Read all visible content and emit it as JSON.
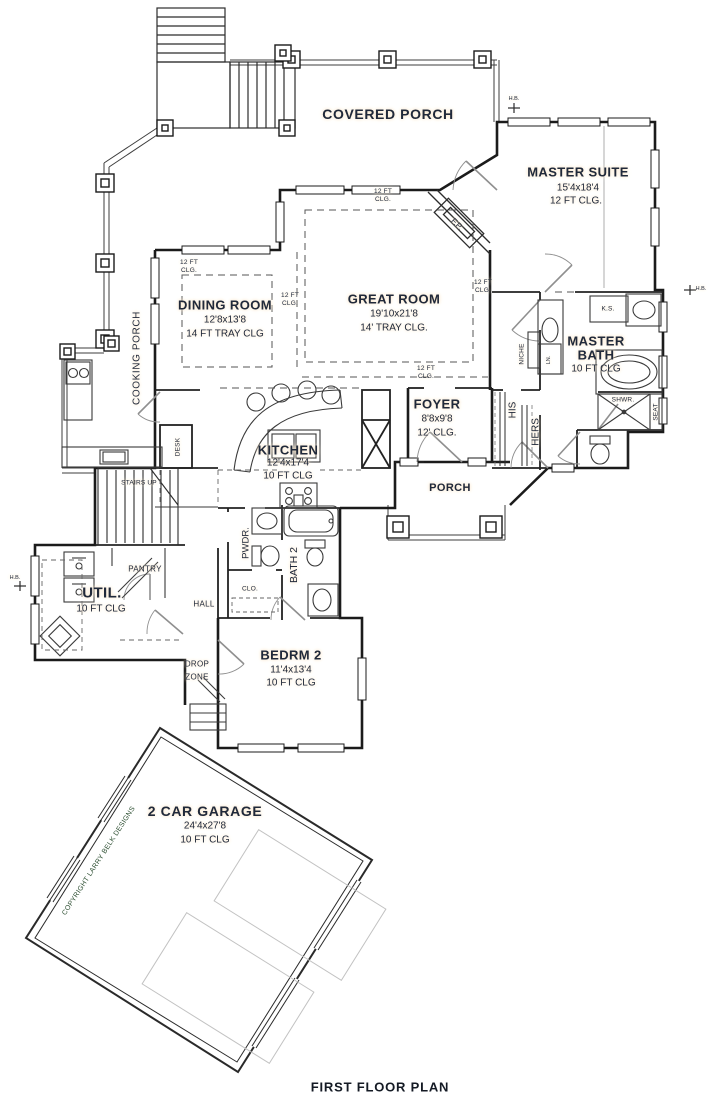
{
  "title": "FIRST FLOOR PLAN",
  "copyright": "COPYRIGHT LARRY BELK DESIGNS",
  "rooms": {
    "covered_porch": {
      "name": "COVERED PORCH"
    },
    "master_suite": {
      "name": "MASTER SUITE",
      "dims": "15'4x18'4",
      "ceiling": "12 FT CLG."
    },
    "dining_room": {
      "name": "DINING ROOM",
      "dims": "12'8x13'8",
      "ceiling": "14 FT TRAY CLG"
    },
    "great_room": {
      "name": "GREAT ROOM",
      "dims": "19'10x21'8",
      "ceiling": "14' TRAY CLG."
    },
    "master_bath": {
      "name_line1": "MASTER",
      "name_line2": "BATH",
      "ceiling": "10 FT CLG"
    },
    "foyer": {
      "name": "FOYER",
      "dims": "8'8x9'8",
      "ceiling": "12' CLG."
    },
    "kitchen": {
      "name": "KITCHEN",
      "dims": "12'4x17'4",
      "ceiling": "10 FT CLG"
    },
    "porch": {
      "name": "PORCH"
    },
    "cooking_porch": {
      "name": "COOKING PORCH"
    },
    "util": {
      "name": "UTIL.",
      "ceiling": "10 FT CLG"
    },
    "bedroom2": {
      "name": "BEDRM 2",
      "dims": "11'4x13'4",
      "ceiling": "10 FT CLG"
    },
    "garage": {
      "name": "2 CAR GARAGE",
      "dims": "24'4x27'8",
      "ceiling": "10 FT CLG"
    }
  },
  "labels": {
    "stairs_up": "STAIRS UP",
    "desk": "DESK",
    "pantry": "PANTRY",
    "hall": "HALL",
    "drop_line1": "DROP",
    "drop_line2": "ZONE",
    "pwdr": "PWDR.",
    "bath2": "BATH 2",
    "clo": "CLO.",
    "his": "HIS",
    "hers": "HERS",
    "niche": "NICHE",
    "linen": "LN.",
    "knee_space": "K.S.",
    "fireplace": "F.P.",
    "shower": "SHWR.",
    "seat": "SEAT",
    "hose_bib": "H.B.",
    "clg_line1": "12 FT",
    "clg_line2": "CLG."
  },
  "colors": {
    "wall": "#1b1b1b",
    "thin_line": "#444444",
    "label_text": "#20293a",
    "label_halo": "#f8e3c4",
    "copyright_green": "#2c4e31",
    "car_gray": "#c2c2c2"
  }
}
